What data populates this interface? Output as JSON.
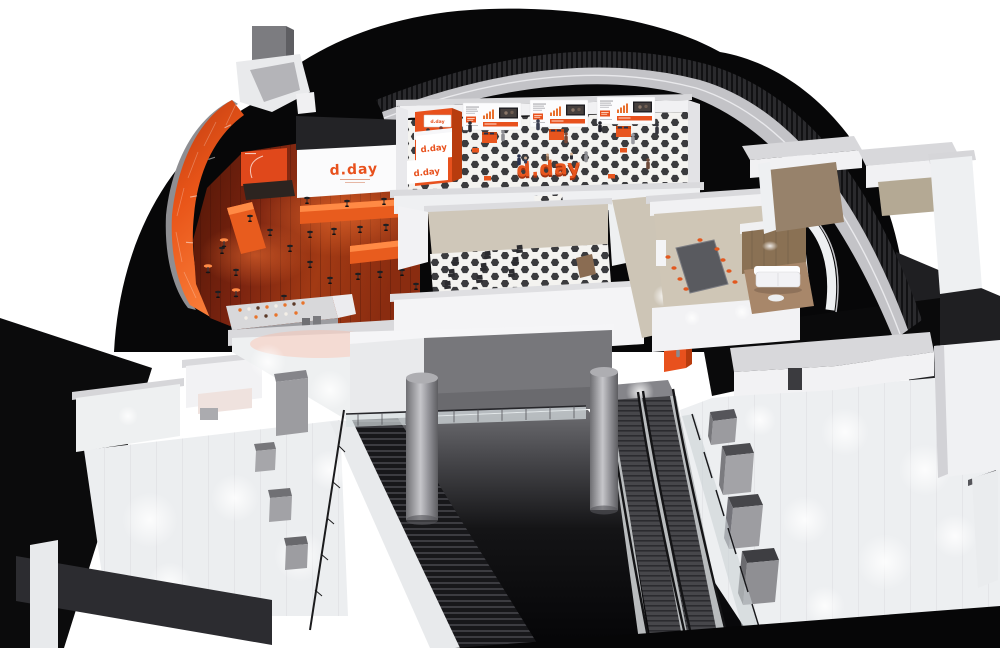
{
  "scene": {
    "title": "d.day venue cutaway render",
    "brand": "d.day",
    "accent_color": "#E8511D"
  },
  "labels": {
    "screen_logo": "d.day",
    "reception_monitor": "d.day",
    "reception_band_top": "d.day",
    "reception_band_bottom": "d.day",
    "floor_seating": "d.day"
  },
  "palette": {
    "brand_orange": "#E8511D",
    "brand_orange_dark": "#B83C0E",
    "silhouette_black": "#070708",
    "wood_floor_red": "#7C2410",
    "checker_dark": "#3B3B3E",
    "wall_white": "#F2F2F4",
    "beige_wall": "#CFC7B9",
    "lower_floor_grey": "#EDEFF1",
    "escalator_grey": "#47474B"
  },
  "regions": [
    {
      "id": "cafe-lounge"
    },
    {
      "id": "presentation-screen"
    },
    {
      "id": "exhibition-hall"
    },
    {
      "id": "reception-tower"
    },
    {
      "id": "seminar-room"
    },
    {
      "id": "meeting-room"
    },
    {
      "id": "sofa-lounge"
    },
    {
      "id": "upper-right-rooms"
    },
    {
      "id": "lower-left-hall"
    },
    {
      "id": "atrium-bridge"
    },
    {
      "id": "staircase"
    },
    {
      "id": "escalators"
    },
    {
      "id": "lower-right-concourse"
    }
  ]
}
